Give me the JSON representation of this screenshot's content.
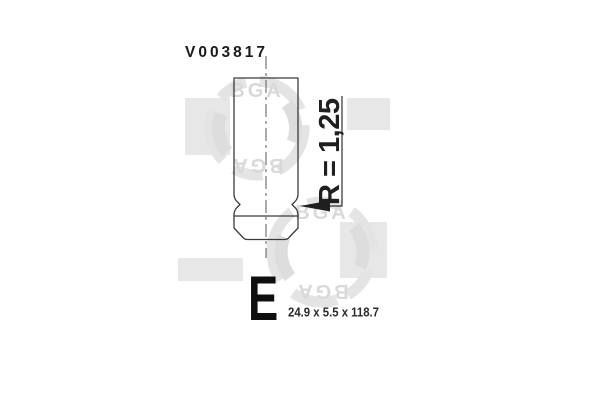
{
  "part_label": "V003817",
  "radius_label": "R = 1,25",
  "type_letter": "E",
  "size_label": "24.9 x 5.5 x 118.7",
  "watermark_text": "BGA",
  "colors": {
    "background": "#ffffff",
    "drawing_line": "#3b3b3b",
    "dimension_arrow": "#1f1f1f",
    "label_text": "#1a1a1a",
    "watermark_gray": "#e6e6e6"
  }
}
